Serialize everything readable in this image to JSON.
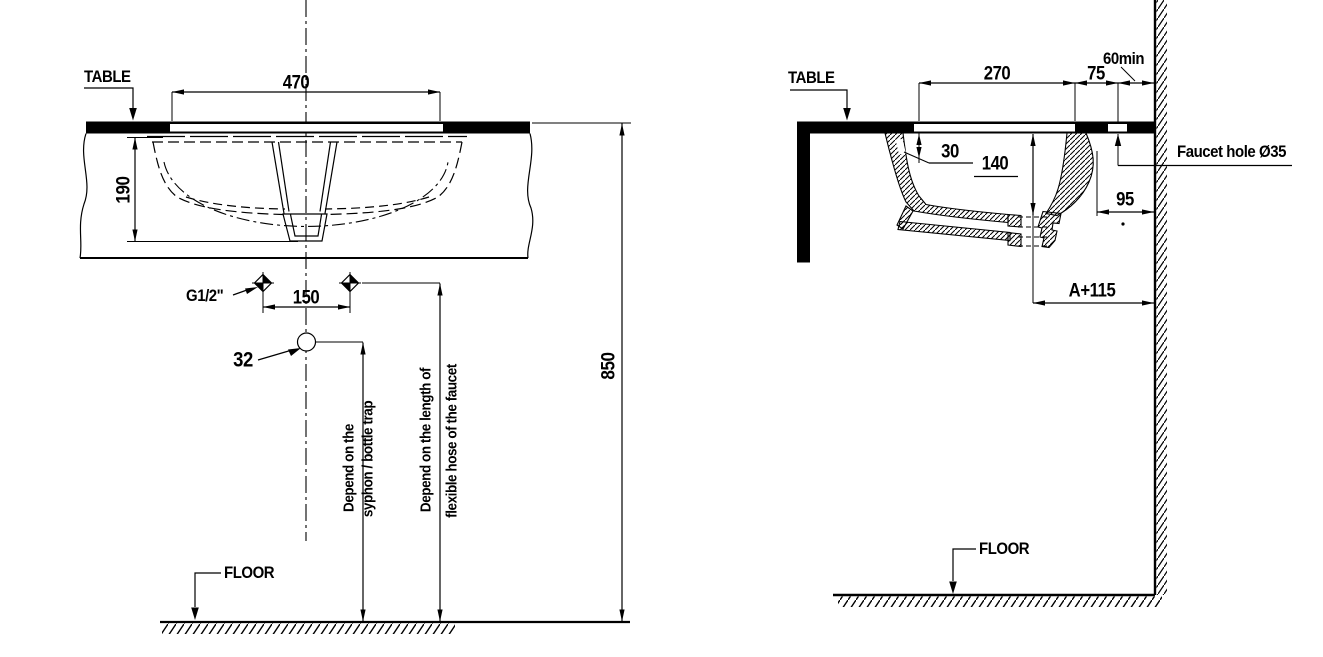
{
  "front_view": {
    "table_label": "TABLE",
    "floor_label": "FLOOR",
    "supply_label": "G1/2\"",
    "drain_label": "32",
    "basin_width": "470",
    "basin_depth": "190",
    "tap_spacing": "150",
    "table_height": "850",
    "note_syphon_line1": "Depend on the",
    "note_syphon_line2": "syphon / bottle trap",
    "note_hose_line1": "Depend on the length of",
    "note_hose_line2": "flexible hose of the faucet"
  },
  "side_view": {
    "table_label": "TABLE",
    "floor_label": "FLOOR",
    "opening_depth": "270",
    "faucet_offset": "75",
    "wall_clearance": "60min",
    "rim_thickness": "30",
    "bowl_depth": "140",
    "rear_clearance": "95",
    "drain_to_wall": "A+115",
    "faucet_hole_label": "Faucet hole Ø35"
  },
  "colors": {
    "line": "#000000",
    "background": "#ffffff"
  }
}
